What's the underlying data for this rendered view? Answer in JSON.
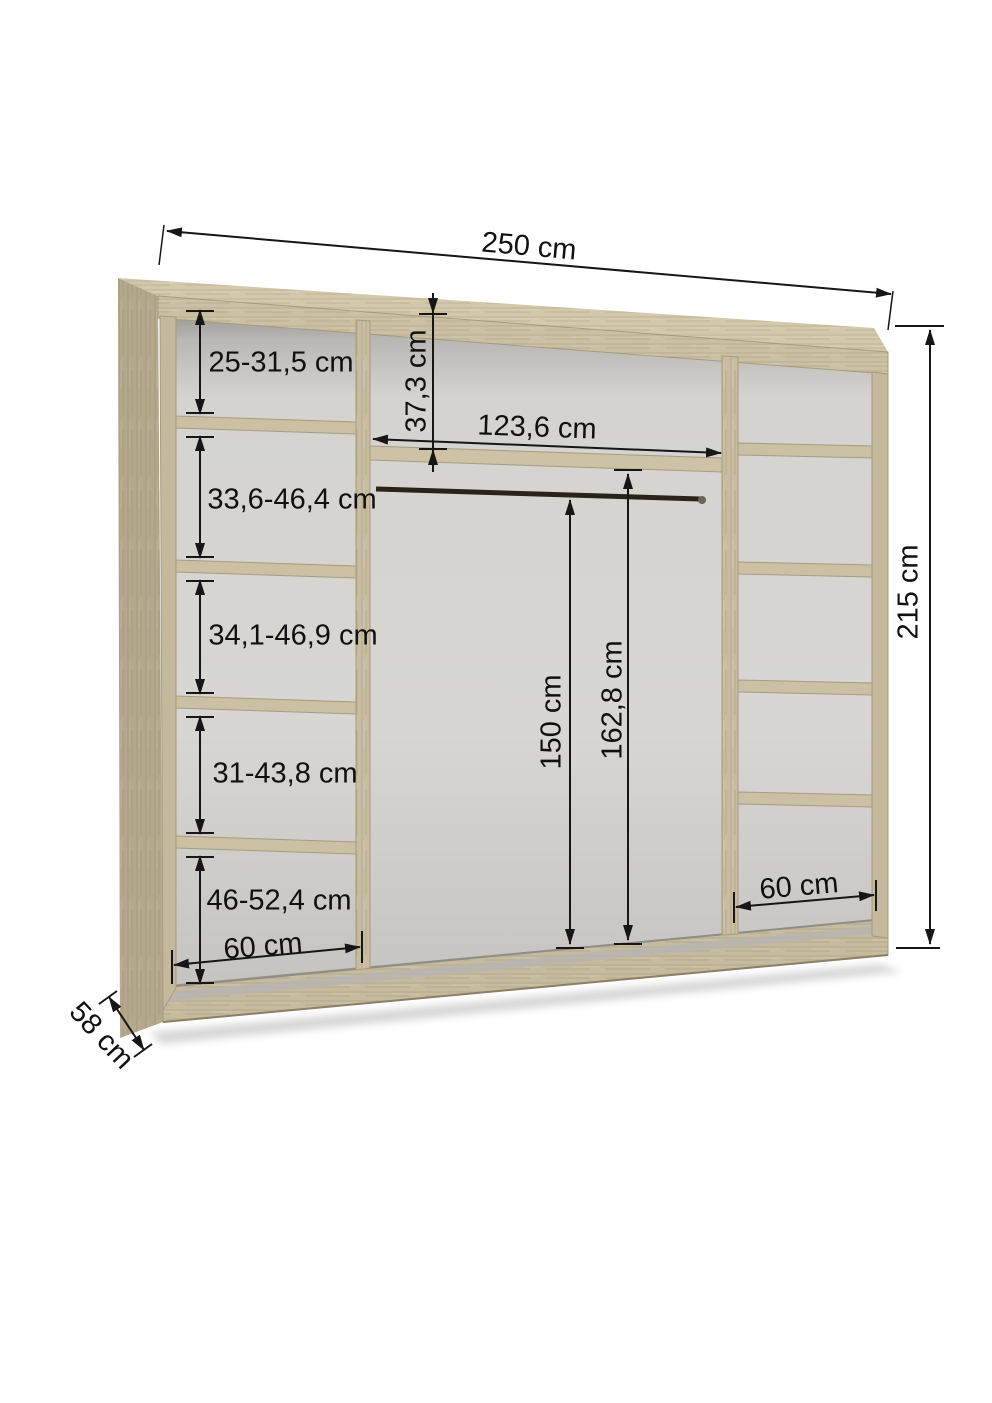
{
  "diagram": {
    "kind": "wardrobe-interior-dimension-diagram",
    "unit": "cm",
    "overall": {
      "width": "250 cm",
      "height": "215 cm",
      "depth": "58 cm"
    },
    "left_column": {
      "width_label": "60 cm",
      "compartments": [
        {
          "label": "25-31,5 cm"
        },
        {
          "label": "33,6-46,4 cm"
        },
        {
          "label": "34,1-46,9 cm"
        },
        {
          "label": "31-43,8 cm"
        },
        {
          "label": "46-52,4 cm"
        }
      ]
    },
    "middle_section": {
      "top_shelf_drop": "37,3 cm",
      "inner_width": "123,6 cm",
      "rail_height": "150 cm",
      "shelf_height": "162,8 cm"
    },
    "right_column": {
      "width_label": "60 cm",
      "shelf_count": 4
    },
    "colors": {
      "wood": "#cbc0a4",
      "wood_light": "#d3c8ac",
      "wood_dark": "#a3977c",
      "back_wall": "#d5d4d0",
      "dimension_line": "#161616",
      "background": "#ffffff"
    }
  }
}
